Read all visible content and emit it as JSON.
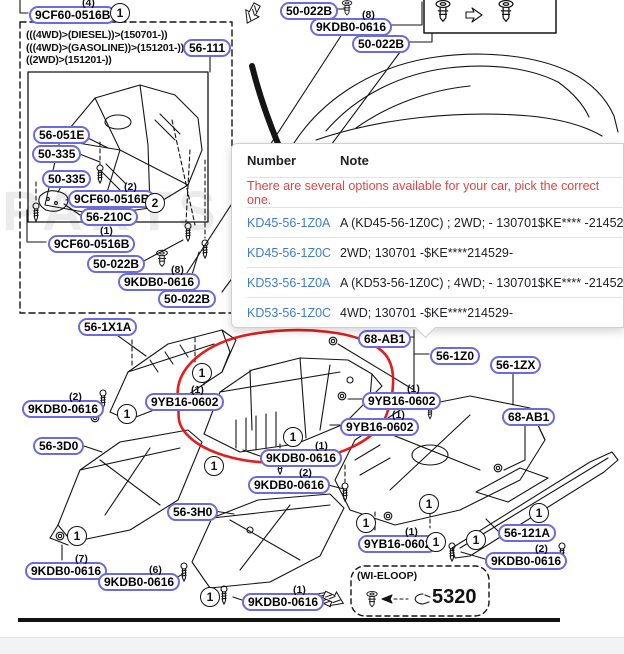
{
  "watermark": "PARTS",
  "variant_box": {
    "lines": [
      "(((4WD)>(DIESEL))>(150701-))",
      "(((4WD)>(GASOLINE))>(151201-))",
      "((2WD)>(151201-))"
    ]
  },
  "labels": [
    {
      "text": "9CF60-0516B",
      "qty": "(4)"
    },
    {
      "text": "56-111"
    },
    {
      "text": "56-051E"
    },
    {
      "text": "50-335"
    },
    {
      "text": "50-335"
    },
    {
      "text": "9CF60-0516B",
      "qty": "(2)"
    },
    {
      "text": "56-210C"
    },
    {
      "text": "9CF60-0516B",
      "qty": "(1)"
    },
    {
      "text": "50-022B"
    },
    {
      "text": "9KDB0-0616",
      "qty": "(8)"
    },
    {
      "text": "50-022B"
    },
    {
      "text": "50-022B"
    },
    {
      "text": "9KDB0-0616",
      "qty": "(8)"
    },
    {
      "text": "50-022B"
    },
    {
      "text": "56-1X1A"
    },
    {
      "text": "9KDB0-0616",
      "qty": "(2)"
    },
    {
      "text": "9YB16-0602",
      "qty": "(1)"
    },
    {
      "text": "68-AB1"
    },
    {
      "text": "56-1Z0"
    },
    {
      "text": "56-1ZX"
    },
    {
      "text": "9YB16-0602",
      "qty": "(1)"
    },
    {
      "text": "9YB16-0602",
      "qty": "(1)"
    },
    {
      "text": "68-AB1"
    },
    {
      "text": "9KDB0-0616",
      "qty": "(1)"
    },
    {
      "text": "9KDB0-0616",
      "qty": "(2)"
    },
    {
      "text": "56-3D0"
    },
    {
      "text": "56-3H0"
    },
    {
      "text": "9KDB0-0616",
      "qty": "(7)"
    },
    {
      "text": "9KDB0-0616",
      "qty": "(6)"
    },
    {
      "text": "9KDB0-0616",
      "qty": "(1)"
    },
    {
      "text": "9YB16-0602",
      "qty": "(1)"
    },
    {
      "text": "56-121A"
    },
    {
      "text": "9KDB0-0616",
      "qty": "(2)"
    }
  ],
  "callouts": [
    "1",
    "2",
    "1",
    "1",
    "1",
    "1",
    "1",
    "1",
    "1",
    "1",
    "1",
    "1",
    "1"
  ],
  "popup": {
    "columns": {
      "number": "Number",
      "note": "Note"
    },
    "warning": "There are several options available for your car, pick the correct one.",
    "rows": [
      {
        "number": "KD45-56-1Z0A",
        "note": "A (KD45-56-1Z0C) ; 2WD; - 130701$KE**** -214529"
      },
      {
        "number": "KD45-56-1Z0C",
        "note": "2WD; 130701 -$KE****214529-"
      },
      {
        "number": "KD53-56-1Z0A",
        "note": "A (KD53-56-1Z0C) ; 4WD; - 130701$KE**** -214529"
      },
      {
        "number": "KD53-56-1Z0C",
        "note": "4WD; 130701 -$KE****214529-"
      }
    ]
  },
  "wi_eloop": {
    "title": "(WI-ELOOP)",
    "code": "5320"
  },
  "colors": {
    "pill_border": "#6b6bdd",
    "highlight_ellipse": "#e11212",
    "warning_text": "#dc4545",
    "link": "#3f7ec6"
  }
}
